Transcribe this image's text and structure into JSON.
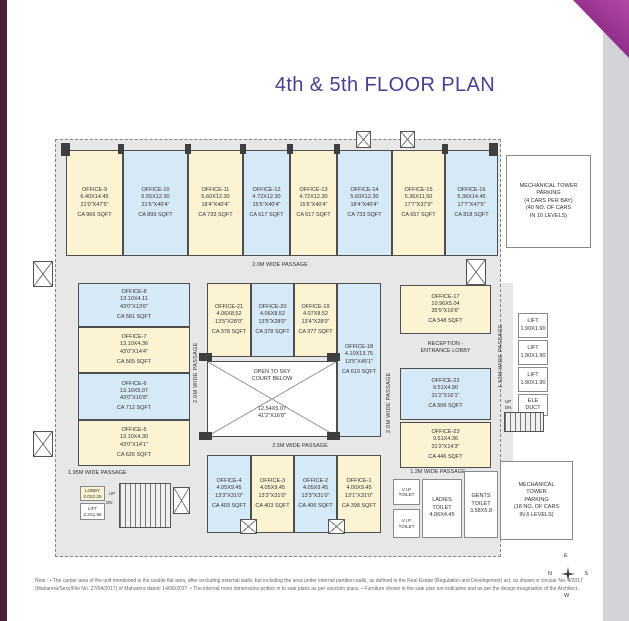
{
  "page": {
    "title": "4th & 5th FLOOR PLAN",
    "note_line1": "Note : • The carpet area of the unit mentioned is the usable flat area, after excluding external walls, but including the area under internal partition walls, as defined in the Real Estate (Regulation and Development) act, as shown in circular No. 4/2017",
    "note_line2": "(Maharera/Secy/File No. 27/04/2017) of Maharera dated: 14/06/2017. • The internal room dimensions written in to sale plans as per sanction plans. • Furniture shown in the sale plan are indicative and as per the design imagination of the Architect."
  },
  "colors": {
    "title_purple": "#4c3e93",
    "fold_magenta": "#8d2b86",
    "left_bar_plum": "#47203a",
    "room_cream": "#fbf3d2",
    "room_blue": "#d6e9f6",
    "passage_gray": "#e7e7e7",
    "wall_dark": "#4e4e4e"
  },
  "offices": {
    "o1": {
      "name": "OFFICE-1",
      "dims": "4.00X9.45\n13'1\"X31'0\"",
      "area": "CA 398 SQFT"
    },
    "o2": {
      "name": "OFFICE-2",
      "dims": "4.05X9.45\n13'3\"X31'0\"",
      "area": "CA 406 SQFT"
    },
    "o3": {
      "name": "OFFICE-3",
      "dims": "4.05X9.45\n13'3\"X31'0\"",
      "area": "CA 403 SQFT"
    },
    "o4": {
      "name": "OFFICE-4",
      "dims": "4.05X9.45\n13'3\"X31'0\"",
      "area": "CA 403 SQFT"
    },
    "o5": {
      "name": "OFFICE-5",
      "dims": "13.10X4.30\n43'0\"X14'1\"",
      "area": "CA 626 SQFT"
    },
    "o6": {
      "name": "OFFICE-6",
      "dims": "13.10X5.07\n43'0\"X16'8\"",
      "area": "CA 712 SQFT"
    },
    "o7": {
      "name": "OFFICE-7",
      "dims": "13.10X4.36\n43'0\"X14'4\"",
      "area": "CA 565 SQFT"
    },
    "o8": {
      "name": "OFFICE-8",
      "dims": "13.10X4.11\n43'0\"X13'6\"",
      "area": "CA 581 SQFT"
    },
    "o9": {
      "name": "OFFICE-9",
      "dims": "6.40X14.45\n21'0\"X47'5\"",
      "area": "CA 966 SQFT"
    },
    "o10": {
      "name": "OFFICE-10",
      "dims": "6.55X12.30\n21'6\"X40'4\"",
      "area": "CA 899 SQFT"
    },
    "o11": {
      "name": "OFFICE-11",
      "dims": "5.60X12.30\n18'4\"X40'4\"",
      "area": "CA 733 SQFT"
    },
    "o12": {
      "name": "OFFICE-12",
      "dims": "4.72X12.30\n15'6\"X40'4\"",
      "area": "CA 617 SQFT"
    },
    "o13": {
      "name": "OFFICE-13",
      "dims": "4.72X12.30\n15'6\"X40'4\"",
      "area": "CA 617 SQFT"
    },
    "o14": {
      "name": "OFFICE-14",
      "dims": "5.60X12.30\n18'4\"X40'4\"",
      "area": "CA 733 SQFT"
    },
    "o15": {
      "name": "OFFICE-15",
      "dims": "5.36X11.50\n17'7\"X37'9\"",
      "area": "CA 657 SQFT"
    },
    "o16": {
      "name": "OFFICE-16",
      "dims": "5.36X14.45\n17'7\"X47'5\"",
      "area": "CA 818 SQFT"
    },
    "o17": {
      "name": "OFFICE-17",
      "dims": "10.96X5.04\n35'9\"X16'6\"",
      "area": "CA 548 SQFT"
    },
    "o18": {
      "name": "OFFICE-18",
      "dims": "4.10X13.75\n13'5\"X45'1\"",
      "area": "CA 610 SQFT"
    },
    "o19": {
      "name": "OFFICE-19",
      "dims": "4.07X8.52\n13'4\"X28'0\"",
      "area": "CA 377 SQFT"
    },
    "o20": {
      "name": "OFFICE-20",
      "dims": "4.06X8.52\n13'5\"X28'0\"",
      "area": "CA 378 SQFT"
    },
    "o21": {
      "name": "OFFICE-21",
      "dims": "4.06X8.52\n13'5\"X28'0\"",
      "area": "CA 378 SQFT"
    },
    "o22": {
      "name": "OFFICE-22",
      "dims": "9.51X4.90\n31'2\"X16'1\"",
      "area": "CA 506 SQFT"
    },
    "o23": {
      "name": "OFFICE-23",
      "dims": "9.51X4.36\n31'2\"X14'3\"",
      "area": "CA 446 SQFT"
    }
  },
  "facilities": {
    "reception": "RECEPTION -\nENTRANCE LOBBY",
    "court_label": "OPEN TO SKY\nCOURT BELOW",
    "court_dims": "12.54X5.07\n41'2\"X16'8\"",
    "parking_top": "MECHANICAL TOWER\nPARKING\n(4 CARS PER BAY)\n(40 NO. OF CARS\nIN 10 LEVELS)",
    "parking_bottom": "MECHANICAL\nTOWER\nPARKING\n(18 NO. OF CARS\nIN 6 LEVELS)",
    "vip_toilet": "V.I.P\nTOILET",
    "ladies_toilet": "LADIES\nTOILET\n4.06X4.45",
    "gents_toilet": "GENTS\nTOILET\n3.58X5.8",
    "lobby": "LOBBY\n2.0X2.25",
    "lift_small": "LIFT\n2.2X1.95",
    "lift": "LIFT\n1.90X1.90",
    "ele_duct": "ELE\nDUCT"
  },
  "passages": {
    "top": "2.0M WIDE PASSAGE",
    "mid": "2.5M WIDE PASSAGE",
    "bottom_left": "1.95M WIDE PASSAGE",
    "bottom_right": "1.2M WIDE PASSAGE",
    "v_left": "2.0M WIDE PASSAGE",
    "v_right": "2.0M WIDE PASSAGE",
    "v_far_right": "1.52M WIDE PASSAGE"
  },
  "stairs": {
    "up": "UP",
    "dn": "DN"
  },
  "compass": {
    "e": "E",
    "n": "N",
    "s": "S",
    "w": "W"
  }
}
